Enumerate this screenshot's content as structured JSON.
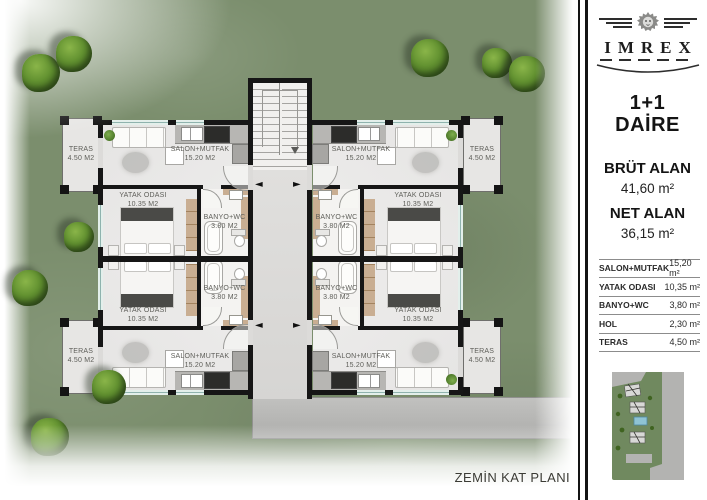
{
  "plan": {
    "title": "ZEMİN KAT PLANI",
    "rooms": {
      "salon": {
        "name": "SALON+MUTFAK",
        "area": "15.20 M2"
      },
      "bedroom": {
        "name": "YATAK ODASI",
        "area": "10.35 M2"
      },
      "bath": {
        "name": "BANYO+WC",
        "area": "3.80 M2"
      },
      "teras": {
        "name": "TERAS",
        "area": "4.50 M2"
      }
    }
  },
  "icons": {
    "arrow_left": "◄",
    "arrow_right": "►"
  },
  "sidebar": {
    "brand": "IMREX",
    "unit": {
      "line1": "1+1",
      "line2": "DAİRE"
    },
    "areas": {
      "gross_label": "BRÜT ALAN",
      "gross_value": "41,60 m²",
      "net_label": "NET ALAN",
      "net_value": "36,15 m²"
    },
    "table": {
      "rows": [
        {
          "label": "SALON+MUTFAK",
          "value": "15,20 m²"
        },
        {
          "label": "YATAK ODASI",
          "value": "10,35 m²"
        },
        {
          "label": "BANYO+WC",
          "value": "3,80 m²"
        },
        {
          "label": "HOL",
          "value": "2,30 m²"
        },
        {
          "label": "TERAS",
          "value": "4,50 m²"
        }
      ]
    }
  },
  "colors": {
    "wall": "#161616",
    "grass": "#7b8e6d",
    "road": "#b6b6b4",
    "window_glass": "#cfe7e2",
    "wood": "#c9ae92"
  }
}
